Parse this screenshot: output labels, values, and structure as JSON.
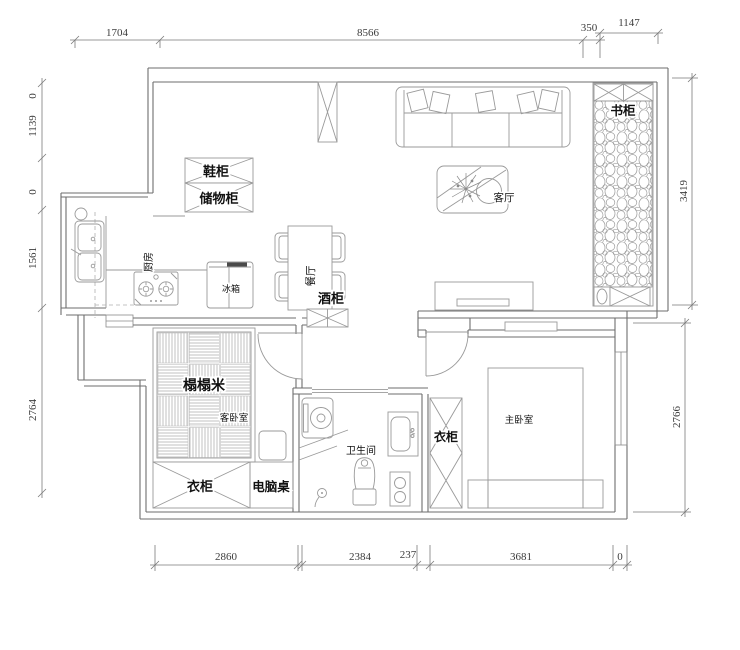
{
  "drawing": {
    "title": "apartment-floor-plan",
    "rooms": {
      "kitchen": "厨房",
      "dining": "餐厅",
      "living": "客厅",
      "guest_bedroom": "客卧室",
      "master_bedroom": "主卧室",
      "bathroom": "卫生间"
    },
    "furniture": {
      "shoe_cabinet": "鞋柜",
      "storage_cabinet": "储物柜",
      "fridge": "冰箱",
      "wine_cabinet": "酒柜",
      "bookcase": "书柜",
      "tatami": "榻榻米",
      "wardrobe_guest": "衣柜",
      "computer_desk": "电脑桌",
      "wardrobe_master": "衣柜"
    },
    "dimensions": {
      "top": [
        "1704",
        "8566",
        "350",
        "1147"
      ],
      "left": [
        "0",
        "1139",
        "0",
        "1561",
        "2764"
      ],
      "right": [
        "3419",
        "2766"
      ],
      "bottom": [
        "2860",
        "2384",
        "237",
        "3681",
        "0"
      ]
    },
    "colors": {
      "background": "#ffffff",
      "wall_line": "#6e6e6e",
      "furniture_line": "#9a9a9a",
      "dimension_line": "#7a7a7a",
      "label_text": "#111111",
      "dimension_text": "#3c3c3c"
    }
  }
}
